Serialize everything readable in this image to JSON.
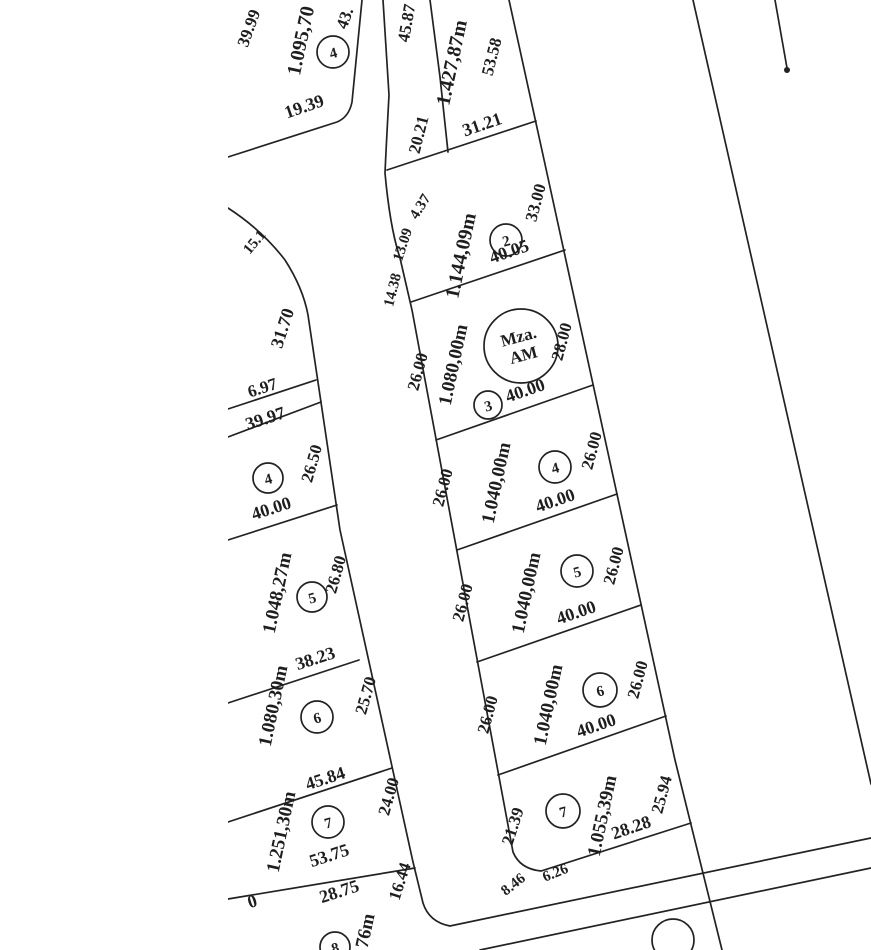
{
  "drawing": {
    "background": "#ffffff",
    "ink_color": "#222222"
  },
  "upper_left_lot": {
    "number": "4",
    "area": "1.095,70",
    "left_side": "39.99",
    "bottom_side": "19.39",
    "right_side_partial": "43."
  },
  "street_labels": {
    "corner_partial": "15.1",
    "left_block_street_side": "31.70"
  },
  "left_block": {
    "sliver_side": "6.97",
    "lots": [
      {
        "number": "4",
        "top_side": "39.97",
        "right_side": "26.50",
        "bottom_side": "40.00"
      },
      {
        "number": "5",
        "area": "1.048,27m",
        "right_side": "26.80",
        "bottom_side": "38.23"
      },
      {
        "number": "6",
        "area": "1.080,30m",
        "right_side": "25.70",
        "bottom_side": "45.84"
      },
      {
        "number": "7",
        "area": "1.251,30m",
        "right_side": "24.00",
        "bottom_side": "53.75"
      },
      {
        "number": "8",
        "area_partial": "76m",
        "top_side": "28.75",
        "right_side": "16.44",
        "left_edge_partial": "0"
      }
    ]
  },
  "right_block": {
    "manzana_line1": "Mza.",
    "manzana_line2": "AM",
    "lots": [
      {
        "area": "1.427,87m",
        "left_upper": "45.87",
        "left_lower": "20.21",
        "right_side": "53.58",
        "bottom_side": "31.21"
      },
      {
        "number": "2",
        "area": "1.144,09m",
        "right_side": "33.00",
        "bottom_side": "40.05",
        "chords": [
          "4.37",
          "13.09",
          "14.38"
        ]
      },
      {
        "number": "3",
        "area": "1.080,00m",
        "left_side": "26.00",
        "right_side": "28.00",
        "bottom_side": "40.00"
      },
      {
        "number": "4",
        "area": "1.040,00m",
        "left_side": "26.00",
        "right_side": "26.00",
        "bottom_side": "40.00"
      },
      {
        "number": "5",
        "area": "1.040,00m",
        "left_side": "26.00",
        "right_side": "26.00",
        "bottom_side": "40.00"
      },
      {
        "number": "6",
        "area": "1.040,00m",
        "left_side": "26.00",
        "right_side": "26.00",
        "bottom_side": "40.00"
      },
      {
        "number": "7",
        "area": "1.055,39m",
        "left_side": "21.39",
        "right_side": "25.94",
        "bottom_side": "28.28",
        "chords": [
          "8.46",
          "6.26"
        ]
      }
    ]
  }
}
